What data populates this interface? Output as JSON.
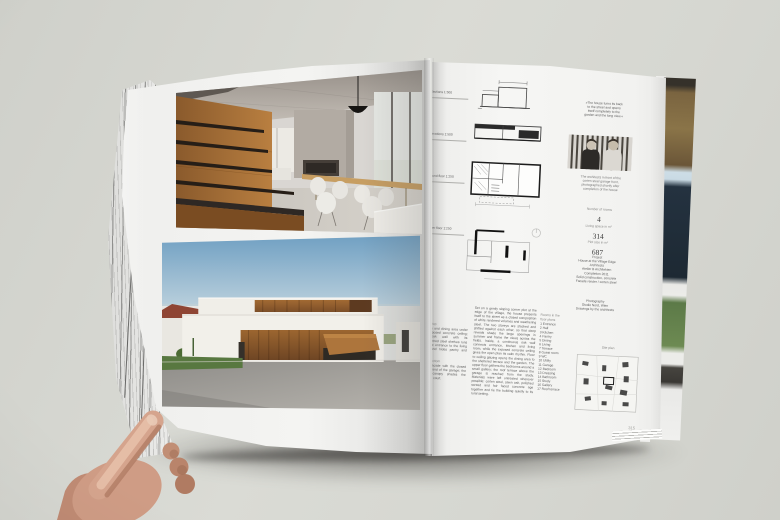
{
  "colors": {
    "wall": "#d6d7d1",
    "page": "#f3f3f1",
    "corten": "#9c6630",
    "sky": "#74a3c6",
    "skin": "#d2a28c",
    "ink": "#5c5c5c"
  },
  "right_page": {
    "margin_labels": [
      "Sections 1:500",
      "Elevations 1:500",
      "Ground floor 1:250",
      "Upper floor 1:250"
    ],
    "quote_lines": [
      "»The house turns its back",
      "to the street and opens",
      "itself completely to the",
      "garden and the long view.«"
    ],
    "portrait_caption_lines": [
      "The architects in front of the",
      "corten steel garage front,",
      "photographed shortly after",
      "completion of the house"
    ],
    "stats": [
      {
        "label": "Number of rooms",
        "value": "4"
      },
      {
        "label": "Living space in m²",
        "value": "314"
      },
      {
        "label": "Plot size in m²",
        "value": "687"
      }
    ],
    "info_lines": [
      "Project",
      "House at the Village Edge",
      "Architects",
      "Atelier B Architekten",
      "Completion 2011",
      "Solid construction, concrete",
      "Facade render / corten steel"
    ],
    "info2_lines": [
      "Photography",
      "Studio Nord, Wien",
      "Drawings by the architects"
    ],
    "captions": [
      {
        "header": "p. 314 top",
        "text": "Kitchen and dining area under the exposed concrete ceiling; the oak wall with its cantilevered steel shelves runs from the entrance to the living room and hides pantry and stair."
      },
      {
        "header": "p. 314 bottom",
        "text": "Street facade with the closed corten band of the garage; the folded canopy shades the entrance court."
      }
    ],
    "description": "Set on a gently sloping corner plot at the edge of the village, the house presents itself to the street as a closed composition of white rendered volumes and weathering steel. The two storeys are stacked and shifted against each other, so that deep reveals shade the large openings in summer and frame the views across the fields. Inside, a continuous oak wall connects entrance, kitchen and living room, while the exposed concrete ceiling gives the open plan its calm rhythm. Floor to ceiling glazing opens the dining area to the sheltered terrace and the garden. The upper floor gathers the bedrooms around a small gallery; the roof terrace above the garage is reached from the study. Materials were left untreated wherever possible: corten steel, sawn oak, polished screed and fair faced concrete age together and tie the building quietly to its rural setting.",
    "legend": {
      "header_lines": [
        "Rooms in the",
        "floor plans"
      ],
      "items": [
        "1 Entrance",
        "2 Hall",
        "3 Kitchen",
        "4 Pantry",
        "5 Dining",
        "6 Living",
        "7 Terrace",
        "8 Guest room",
        "9 WC",
        "10 Utility",
        "11 Garage",
        "12 Bedroom",
        "13 Dressing",
        "14 Bathroom",
        "15 Study",
        "16 Gallery",
        "17 Roof terrace"
      ]
    },
    "site_plan_label": "Site plan",
    "page_number": "315"
  }
}
